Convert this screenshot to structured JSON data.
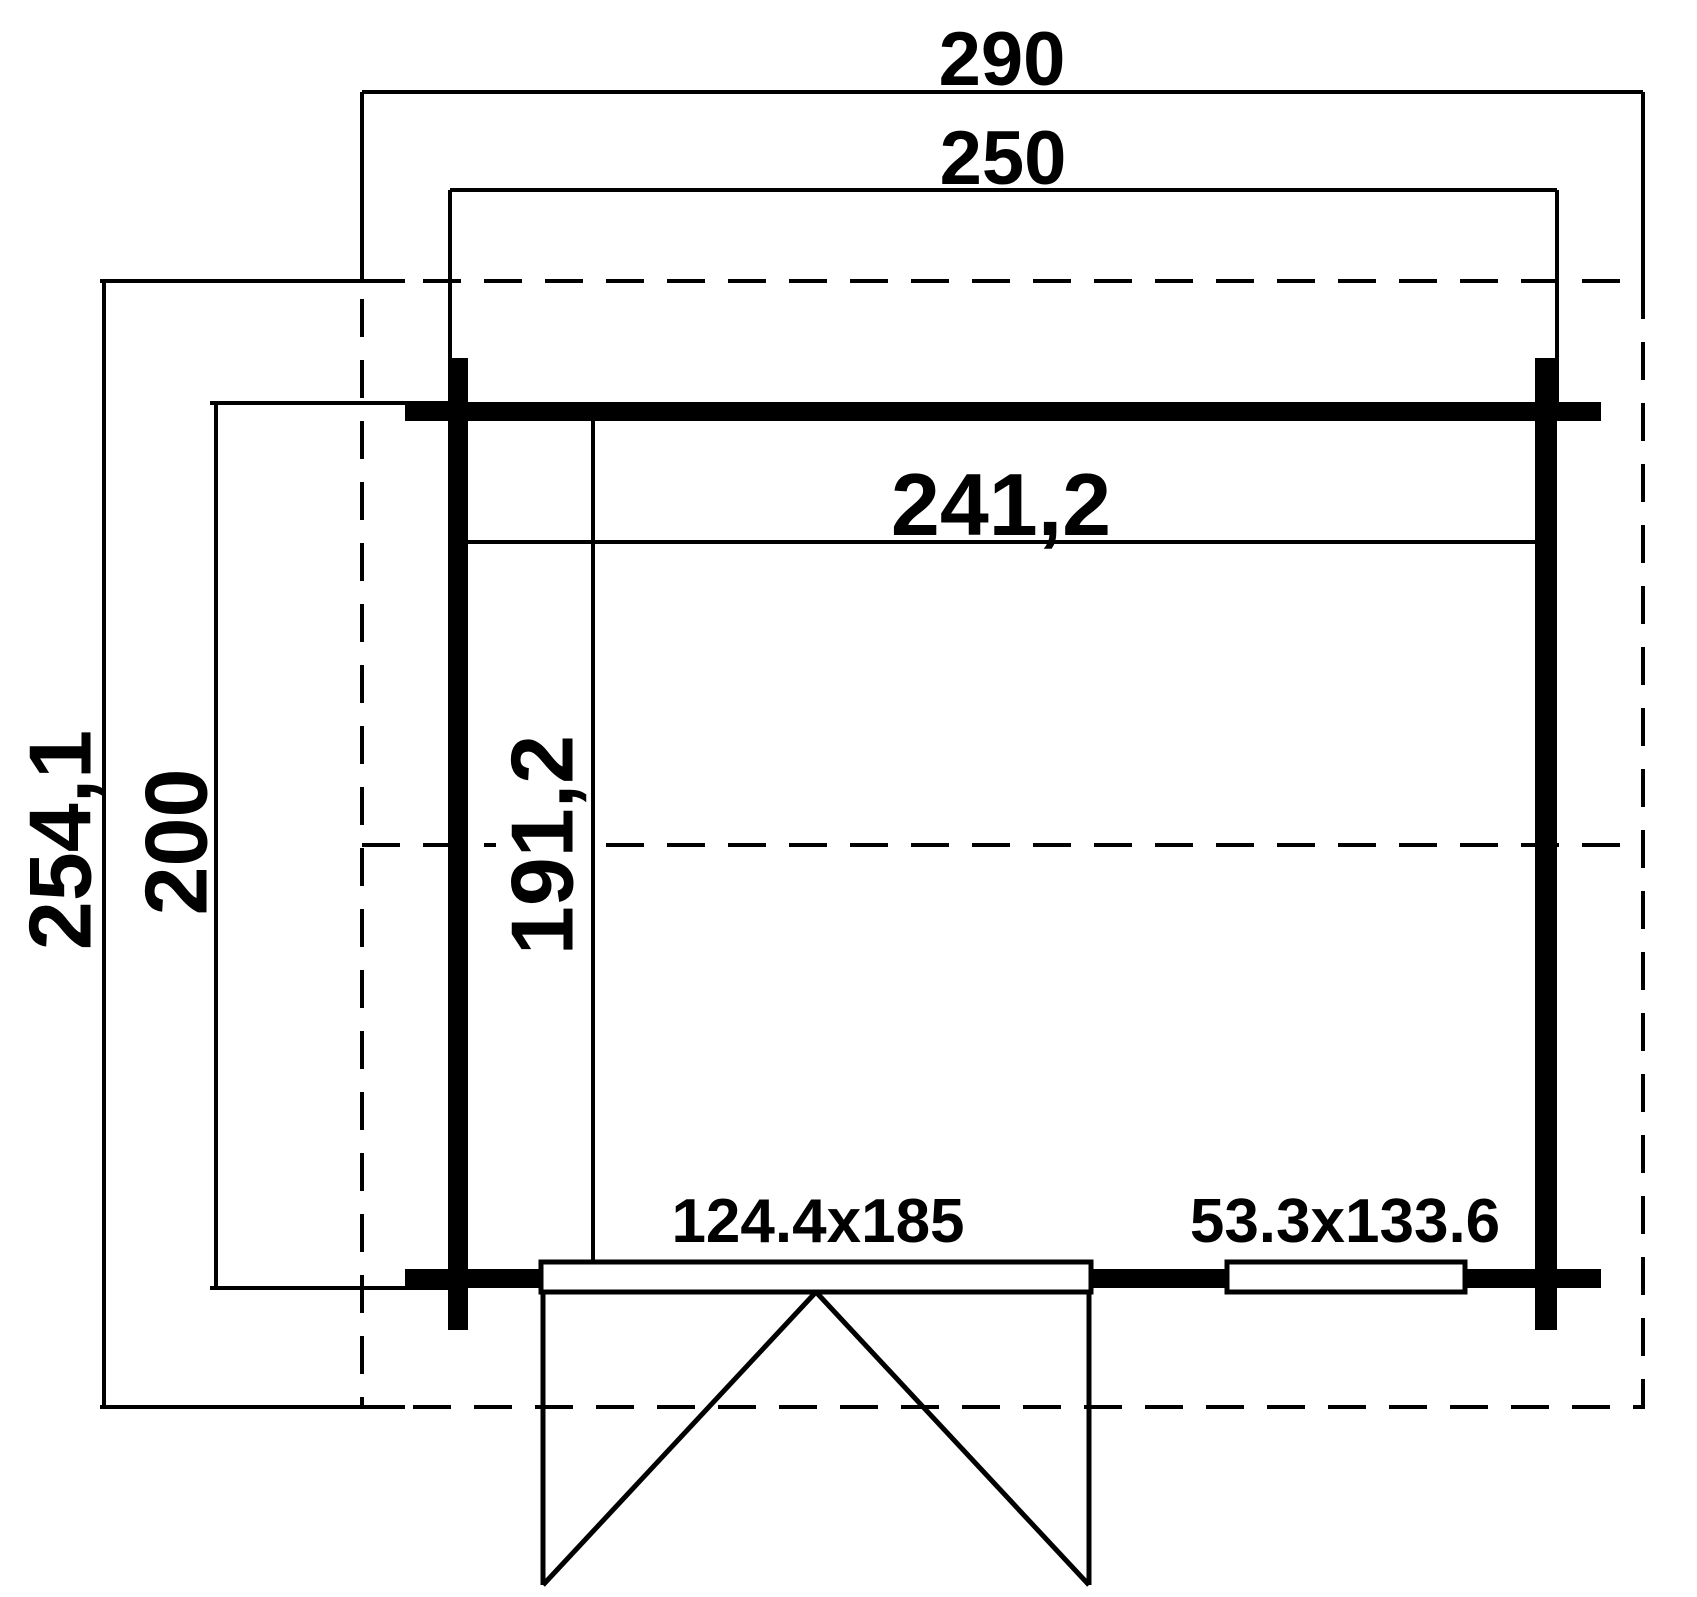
{
  "drawing": {
    "kind": "floor-plan",
    "colors": {
      "line": "#000000",
      "background": "#ffffff"
    },
    "labels": {
      "overall_width": "290",
      "outer_width": "250",
      "overall_depth": "254,1",
      "outer_depth": "200",
      "inner_width": "241,2",
      "inner_depth": "191,2",
      "door": "124.4x185",
      "window": "53.3x133.6"
    }
  }
}
